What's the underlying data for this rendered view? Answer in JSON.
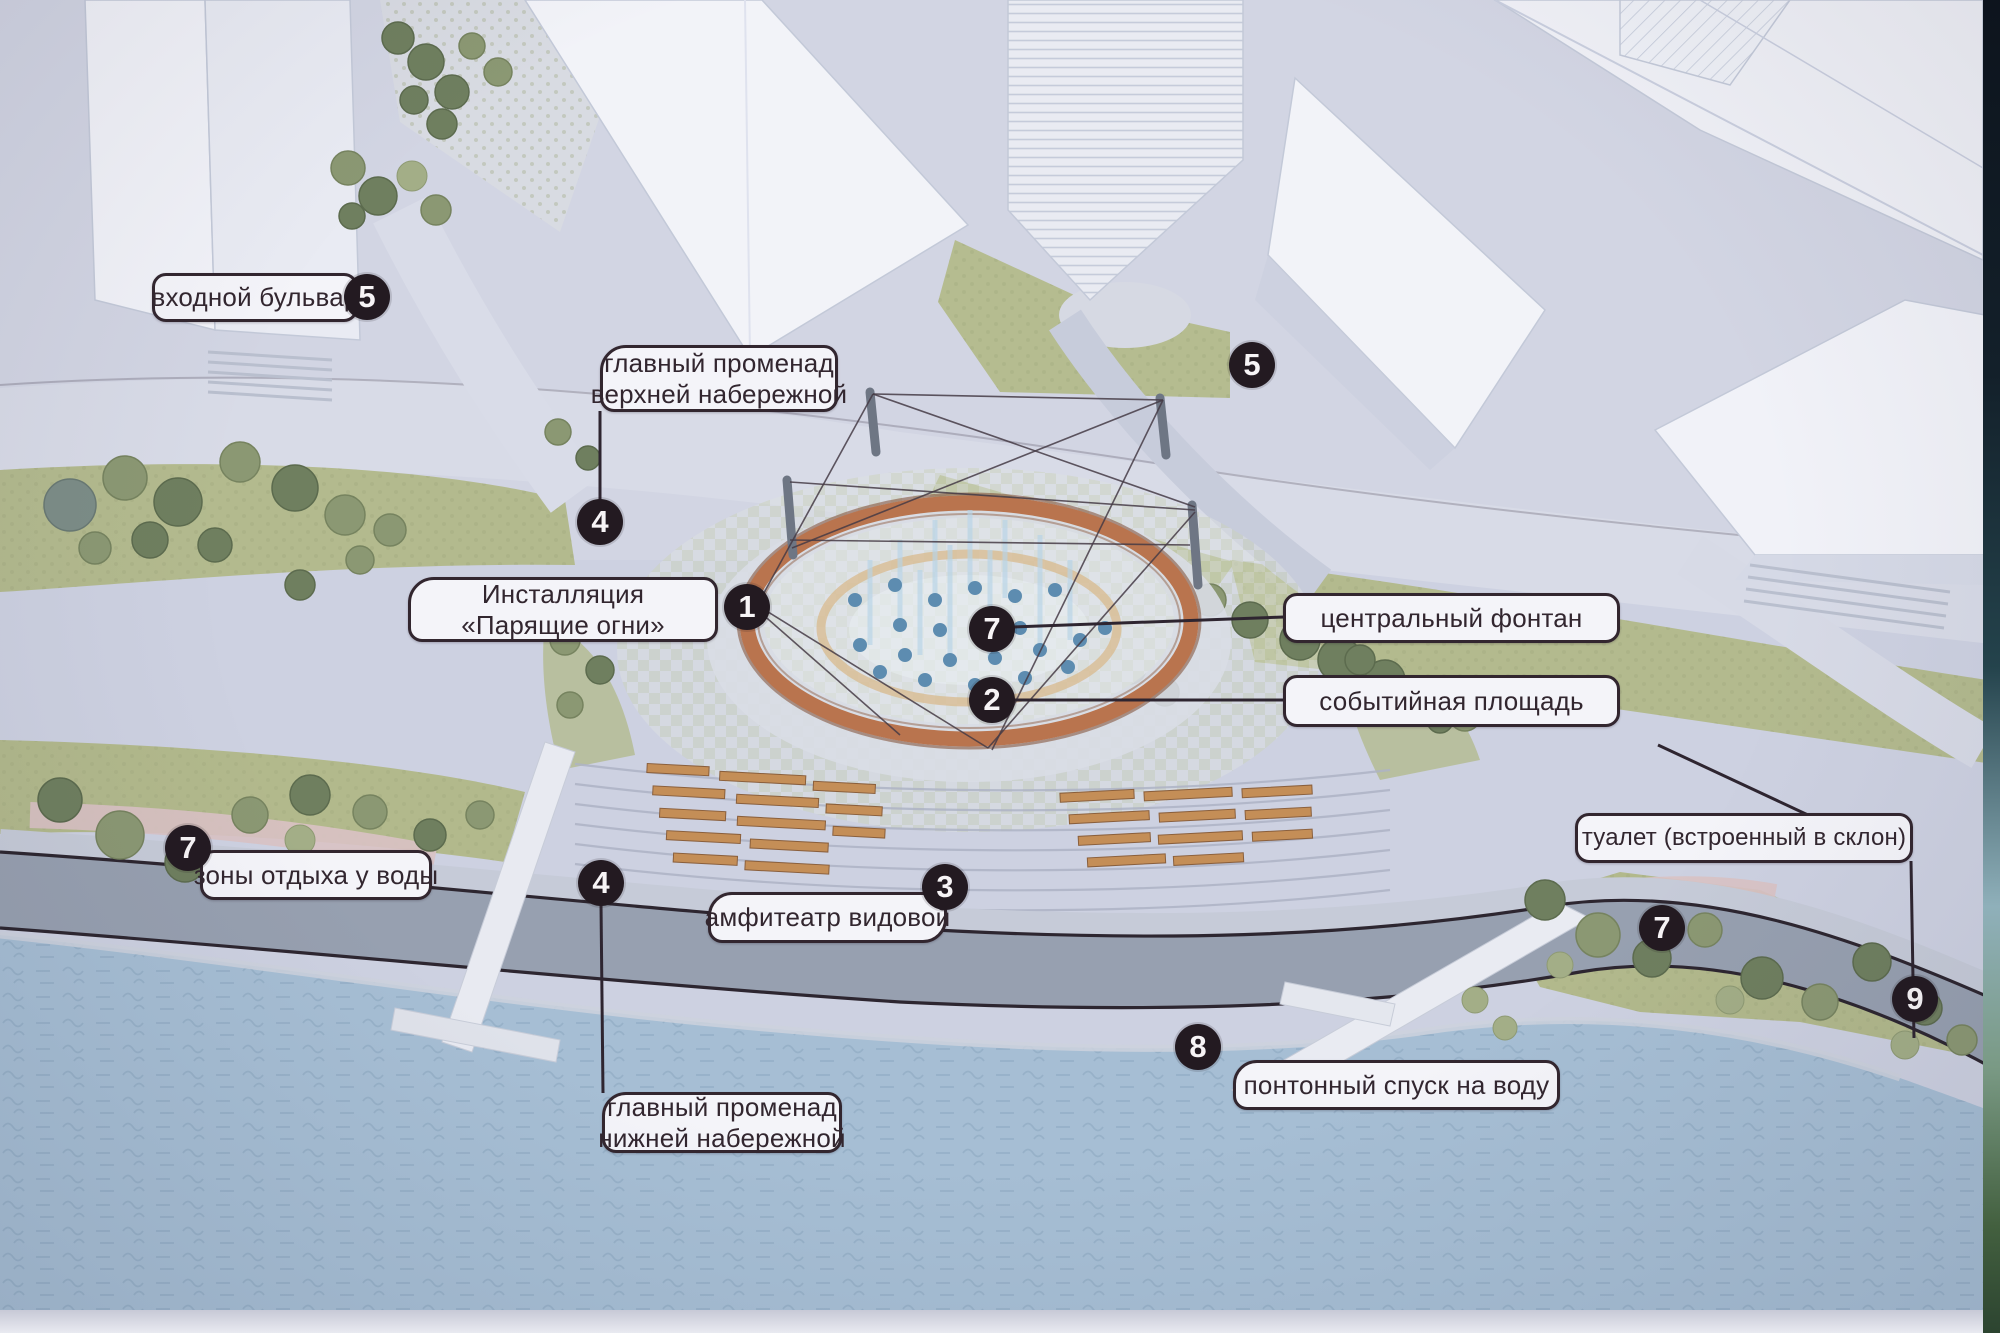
{
  "scene": {
    "type": "waterfront-park-masterplan",
    "language": "ru"
  },
  "callouts": [
    {
      "id": "entrance-boulevard",
      "number": "5",
      "lines": [
        "входной бульвар"
      ]
    },
    {
      "id": "upper-promenade",
      "number": "4",
      "lines": [
        "главный променад",
        "верхней набережной"
      ]
    },
    {
      "id": "installation-soaring-lights",
      "number": "1",
      "lines": [
        "Инсталляция",
        "«Парящие огни»"
      ]
    },
    {
      "id": "central-fountain",
      "number": "7",
      "lines": [
        "центральный фонтан"
      ]
    },
    {
      "id": "event-square",
      "number": "2",
      "lines": [
        "событийная площадь"
      ]
    },
    {
      "id": "waterside-rest-zones",
      "number": "7",
      "lines": [
        "зоны отдыха у воды"
      ]
    },
    {
      "id": "viewing-amphitheatre",
      "number": "3",
      "lines": [
        "амфитеатр видовой"
      ]
    },
    {
      "id": "toilet-built-into-slope",
      "number": "9",
      "lines": [
        "туалет (встроенный в склон)"
      ]
    },
    {
      "id": "pontoon-water-access",
      "number": "8",
      "lines": [
        "понтонный спуск на воду"
      ]
    },
    {
      "id": "lower-promenade",
      "number": "4",
      "lines": [
        "главный променад",
        "нижней набережной"
      ]
    }
  ],
  "floating_markers": [
    {
      "id": "plaza-marker",
      "number": "5"
    },
    {
      "id": "right-bank-marker",
      "number": "7"
    }
  ],
  "colors": {
    "plaza": "#cdd1e1",
    "lawn": "#b3ba8e",
    "water": "#a6bed4",
    "promenade": "#97a0b0",
    "fountain_ring": "#b9744e",
    "label_border": "#32262f",
    "marker_bg": "#231a21",
    "bench": "#c48e57"
  }
}
